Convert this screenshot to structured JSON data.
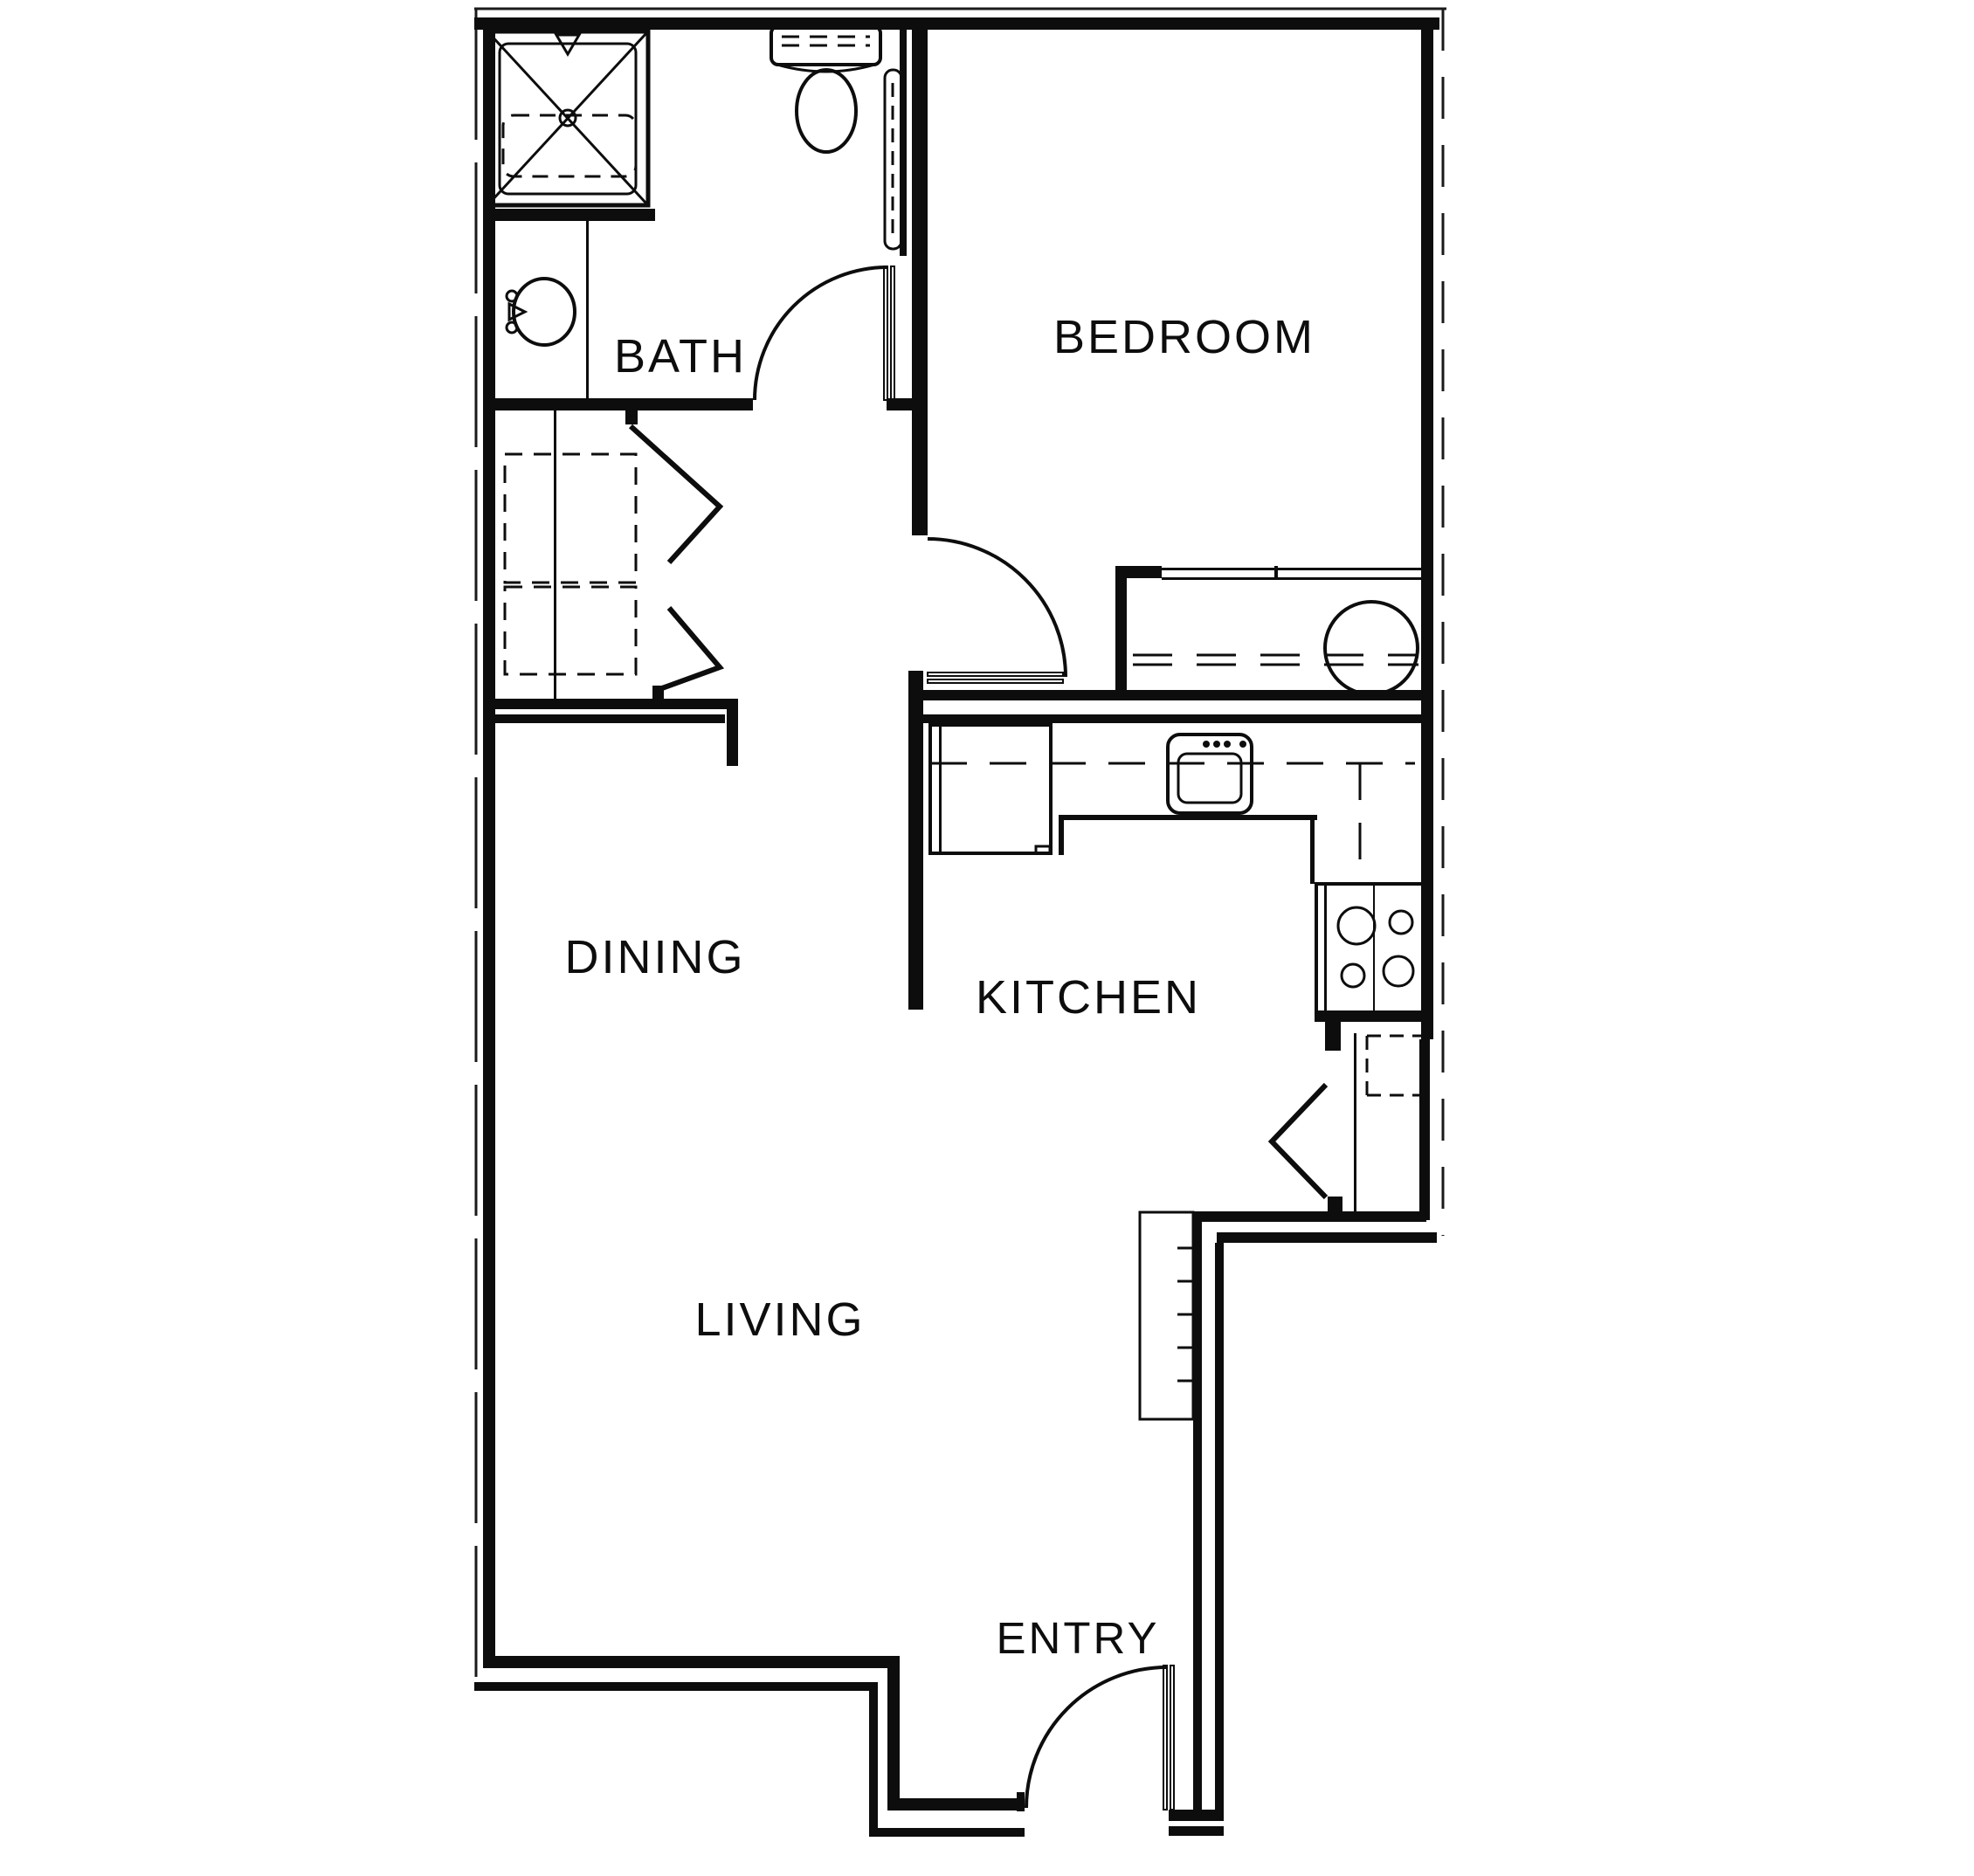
{
  "document": {
    "type": "architectural floor plan",
    "description": "One-bedroom apartment floor plan, black line drawing on white"
  },
  "colors": {
    "line": "#0d0d0d",
    "background": "#ffffff"
  },
  "rooms": {
    "bath": {
      "label": "BATH"
    },
    "bedroom": {
      "label": "BEDROOM"
    },
    "dining": {
      "label": "DINING"
    },
    "kitchen": {
      "label": "KITCHEN"
    },
    "living": {
      "label": "LIVING"
    },
    "entry": {
      "label": "ENTRY"
    }
  },
  "fixtures": [
    "shower",
    "toilet",
    "bathroom-sink",
    "wall-cabinet",
    "laundry-closet-bifold-doors",
    "washer-dryer-dashed-boxes",
    "bedroom-closet-sliding-doors",
    "water-heater",
    "refrigerator",
    "kitchen-sink",
    "stove",
    "pantry-bifold-door",
    "pantry-shelves",
    "dining-counter",
    "stairs",
    "bath-door",
    "bedroom-door",
    "entry-door"
  ]
}
